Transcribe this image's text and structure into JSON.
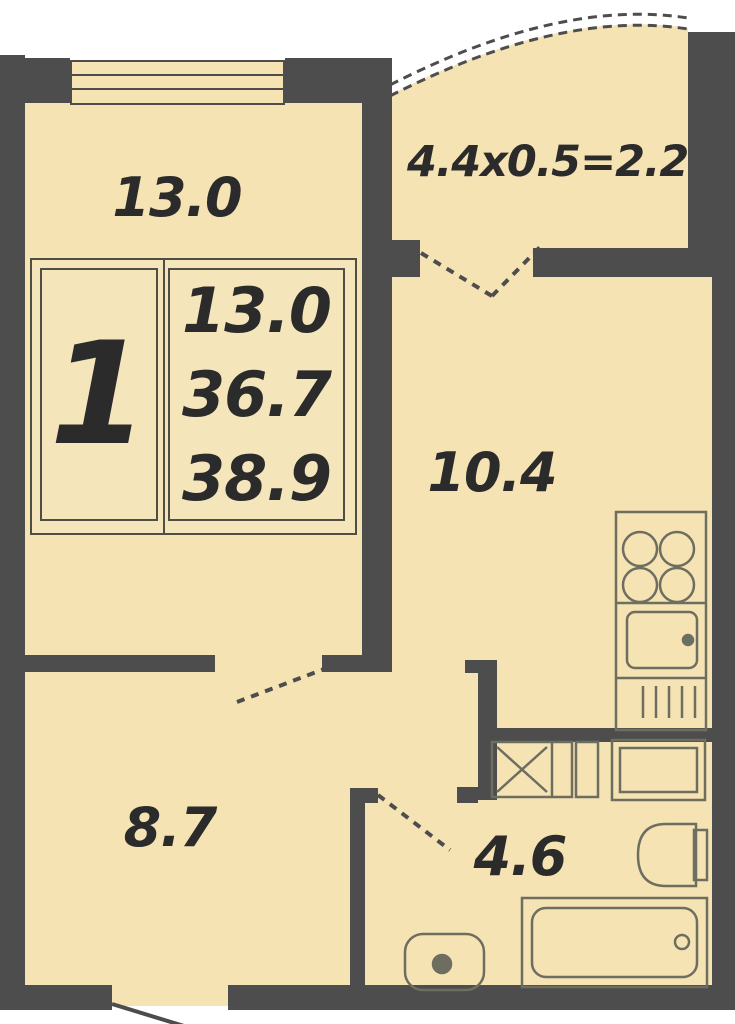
{
  "plan": {
    "title": "apartment-floor-plan",
    "colors": {
      "wall": "#4d4d4d",
      "room_fill": "#f5e3b4",
      "fixture_stroke": "#6e6e60",
      "text": "#2b2b2b",
      "info_box_fill": "#f5e5bb"
    },
    "rooms": {
      "living_room": {
        "area": "13.0"
      },
      "balcony": {
        "dimensions": "4.4x0.5=2.2"
      },
      "kitchen": {
        "area": "10.4"
      },
      "hall": {
        "area": "8.7"
      },
      "bathroom": {
        "area": "4.6"
      }
    },
    "info_box": {
      "room_count": "1",
      "living_area": "13.0",
      "area": "36.7",
      "total_area": "38.9"
    }
  }
}
